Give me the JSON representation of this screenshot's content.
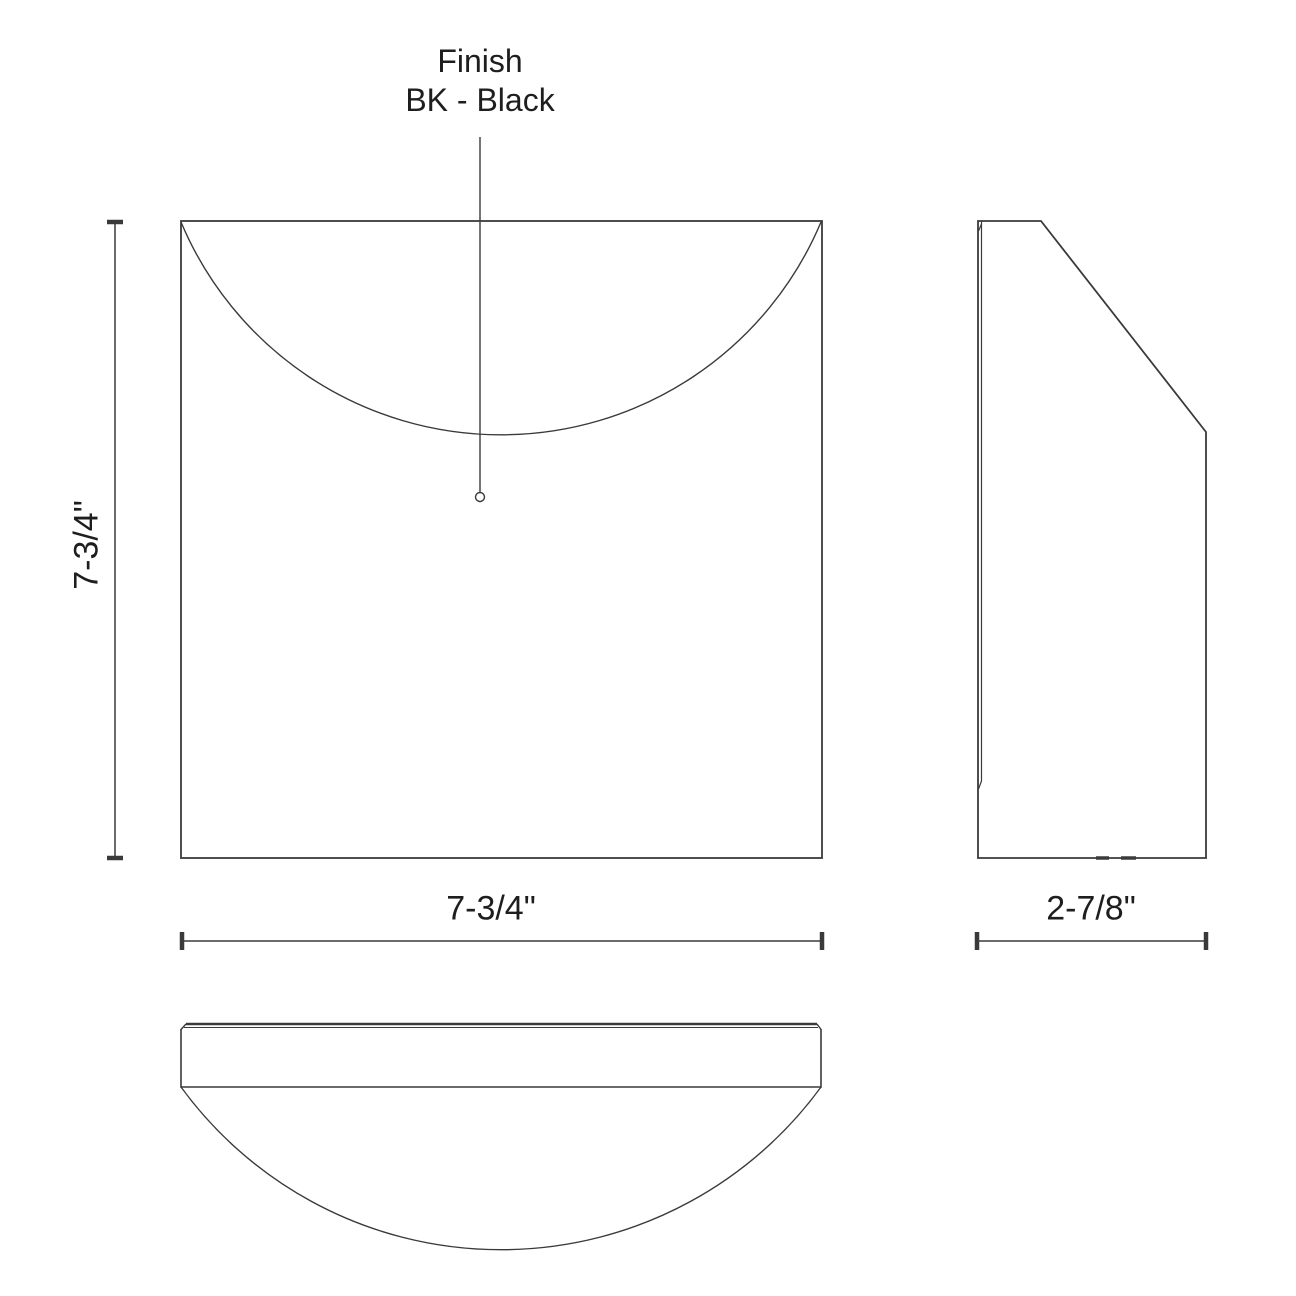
{
  "finish_label": {
    "line1": "Finish",
    "line2": "BK - Black"
  },
  "dimensions": {
    "height": "7-3/4\"",
    "width": "7-3/4\"",
    "depth": "2-7/8\""
  },
  "colors": {
    "line": "#3a3a3a",
    "text": "#1e1e1e",
    "background": "#ffffff"
  }
}
